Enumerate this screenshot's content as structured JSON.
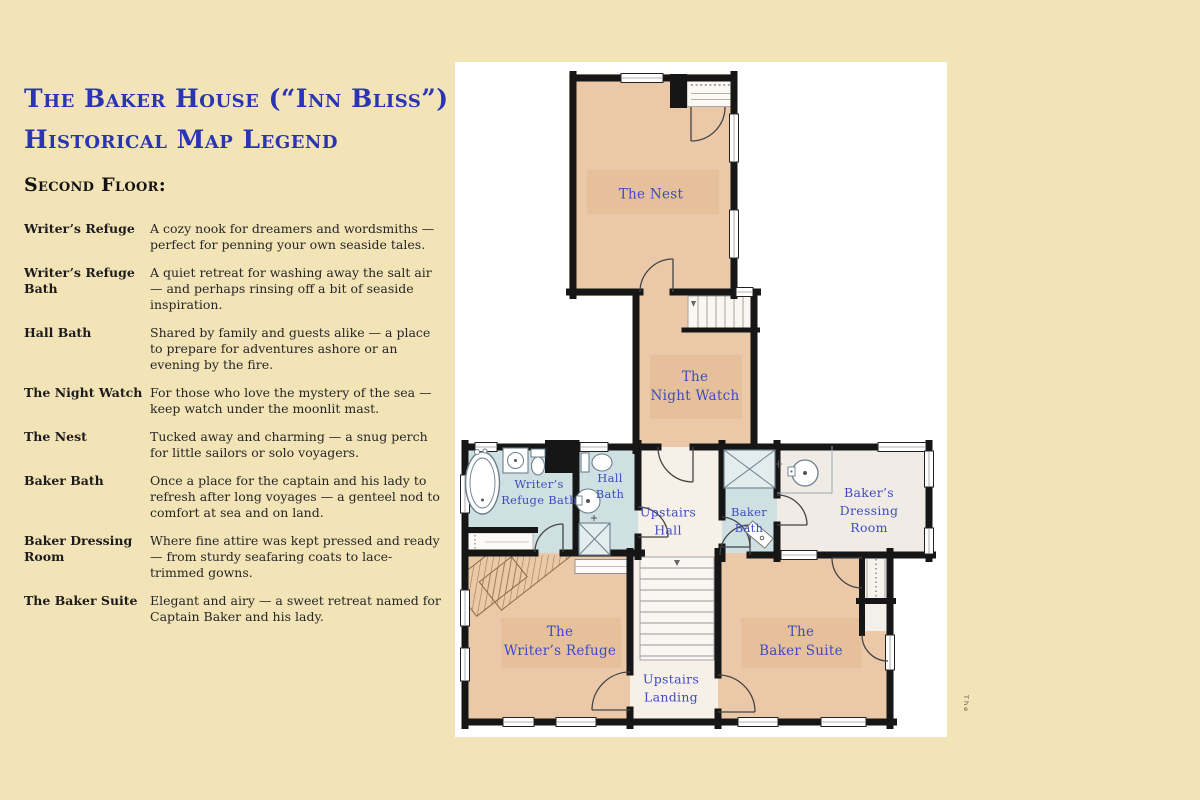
{
  "header": {
    "title_line1": "The Baker House (“Inn Bliss”)",
    "title_line2": "Historical Map Legend",
    "section_heading": "Second Floor:"
  },
  "legend": {
    "entries": [
      {
        "term": "Writer’s Refuge",
        "description": "A cozy nook for dreamers and wordsmiths — perfect for penning your own seaside tales."
      },
      {
        "term": "Writer’s Refuge Bath",
        "description": "A quiet retreat for washing away the salt air — and perhaps rinsing off a bit of seaside inspiration."
      },
      {
        "term": "Hall Bath",
        "description": "Shared by family and guests alike — a place to prepare for adventures ashore or an evening by the fire."
      },
      {
        "term": "The Night Watch",
        "description": "For those who love the mystery of the sea — keep watch under the moonlit mast."
      },
      {
        "term": "The Nest",
        "description": "Tucked away and charming — a snug perch for little sailors or solo voyagers."
      },
      {
        "term": "Baker Bath",
        "description": "Once a place for the captain and his lady to refresh after long voyages — a genteel nod to comfort at sea and on land."
      },
      {
        "term": "Baker Dressing Room",
        "description": "Where fine attire was kept pressed and ready — from sturdy seafaring coats to lace-trimmed gowns."
      },
      {
        "term": "The Baker Suite",
        "description": "Elegant and airy — a sweet retreat named for Captain Baker and his lady."
      }
    ]
  },
  "floorplan": {
    "side_text": "The",
    "rooms": [
      {
        "id": "nest",
        "label": "The Nest"
      },
      {
        "id": "night-watch",
        "label": "The\nNight Watch"
      },
      {
        "id": "writers-refuge-bath",
        "label": "Writer’s\nRefuge Bath"
      },
      {
        "id": "hall-bath",
        "label": "Hall\nBath"
      },
      {
        "id": "upstairs-hall",
        "label": "Upstairs\nHall"
      },
      {
        "id": "baker-bath",
        "label": "Baker\nBath"
      },
      {
        "id": "bakers-dressing-room",
        "label": "Baker’s Dressing\nRoom"
      },
      {
        "id": "writers-refuge",
        "label": "The\nWriter’s Refuge"
      },
      {
        "id": "upstairs-landing",
        "label": "Upstairs\nLanding"
      },
      {
        "id": "baker-suite",
        "label": "The\nBaker Suite"
      }
    ],
    "colors": {
      "background": "#f3e4b7",
      "panel": "#ffffff",
      "title_blue": "#2a35b4",
      "room_label_blue": "#3c4cc4",
      "room_tan": "#ebc9a8",
      "bath_blue": "#cfe0e2",
      "hall_cream": "#f7f0e8",
      "dressing_cream": "#f0ebe4",
      "wall_black": "#161616"
    }
  }
}
